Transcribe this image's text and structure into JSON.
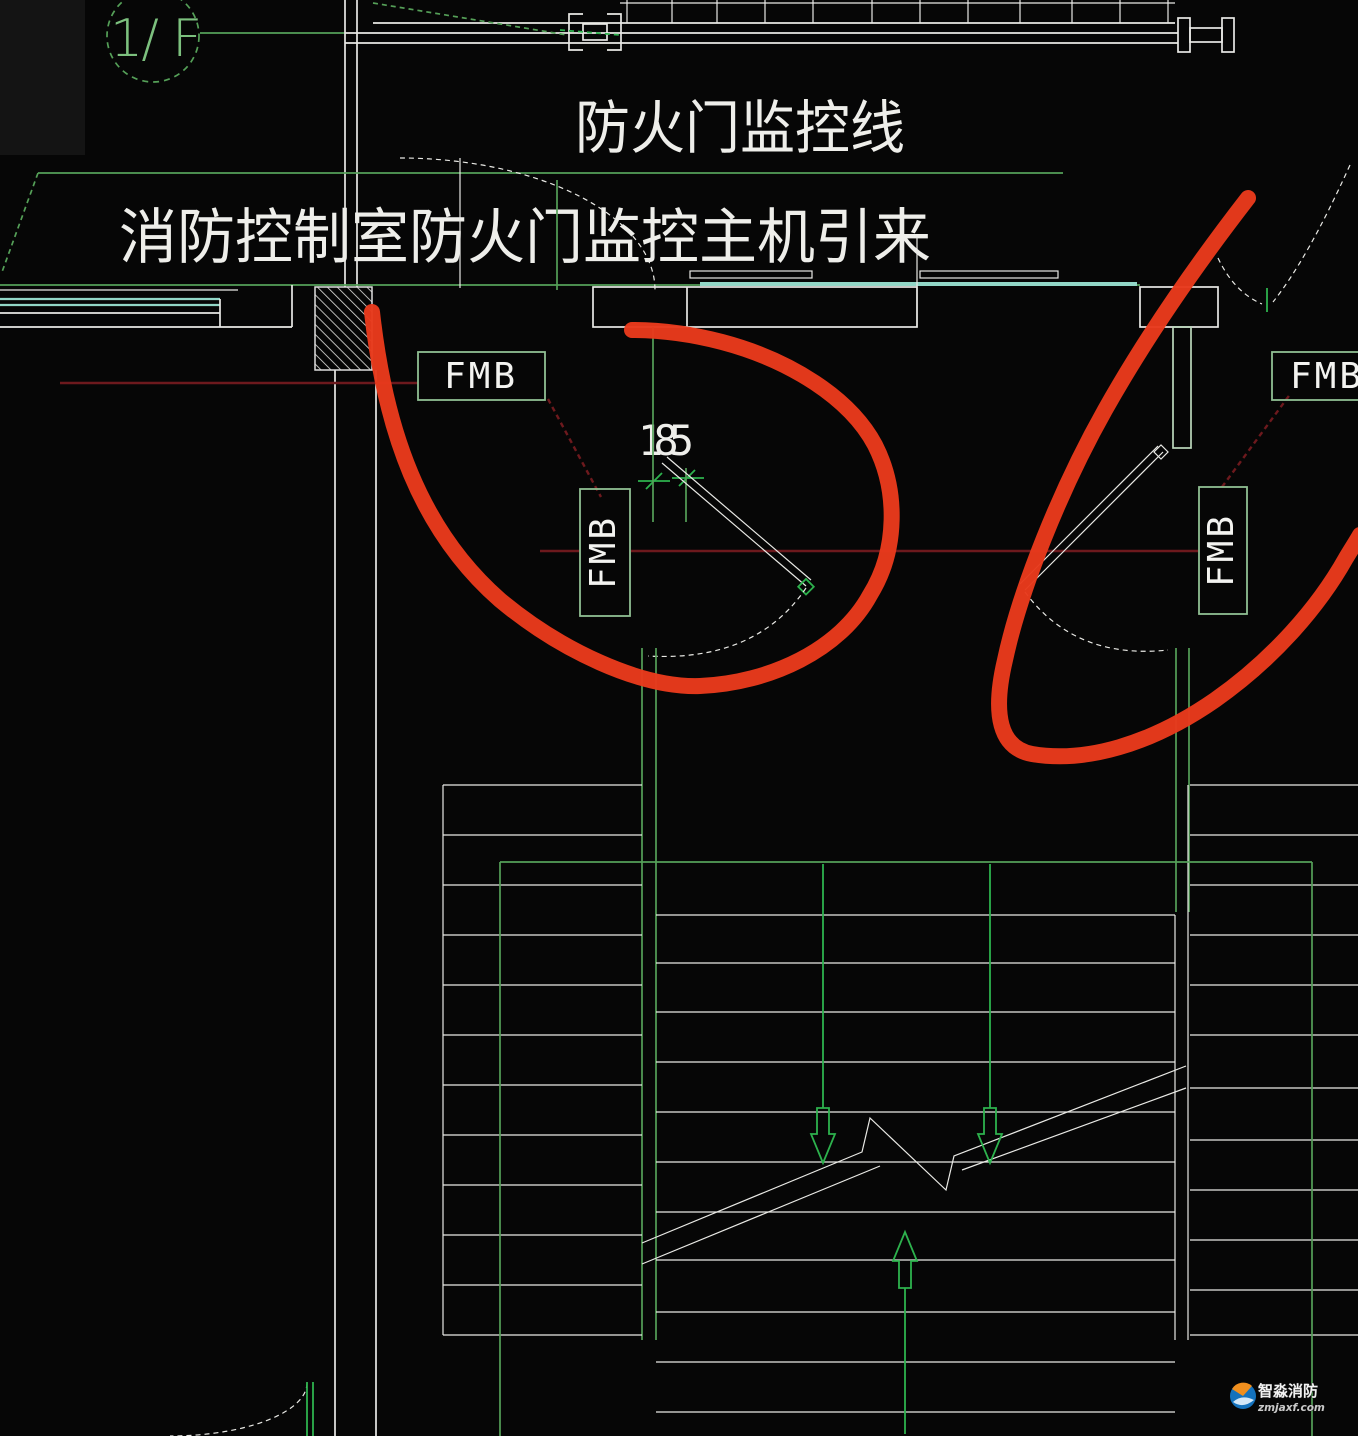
{
  "drawing": {
    "floor_tag": "1/ F",
    "note_top": "防火门监控线",
    "note_main": "消防控制室防火门监控主机引来",
    "dim_value": "185",
    "labels": {
      "fmb_wall": "FMB",
      "fmb_door_left": "FMB",
      "fmb_door_right": "FMB",
      "fmb_right_edge": "FMB"
    },
    "colors": {
      "cad_green": "#55a058",
      "cad_green_bright": "#2db24d",
      "cad_white": "#e9e9e5",
      "cad_cyan": "#92d7c7",
      "marker_red": "#e83a1c",
      "leader_dark_red": "#6d191d",
      "box_green": "#8fbf92",
      "text_white": "#eeeeea"
    }
  },
  "watermark": {
    "brand": "智淼消防",
    "site": "zmjaxf.com"
  }
}
